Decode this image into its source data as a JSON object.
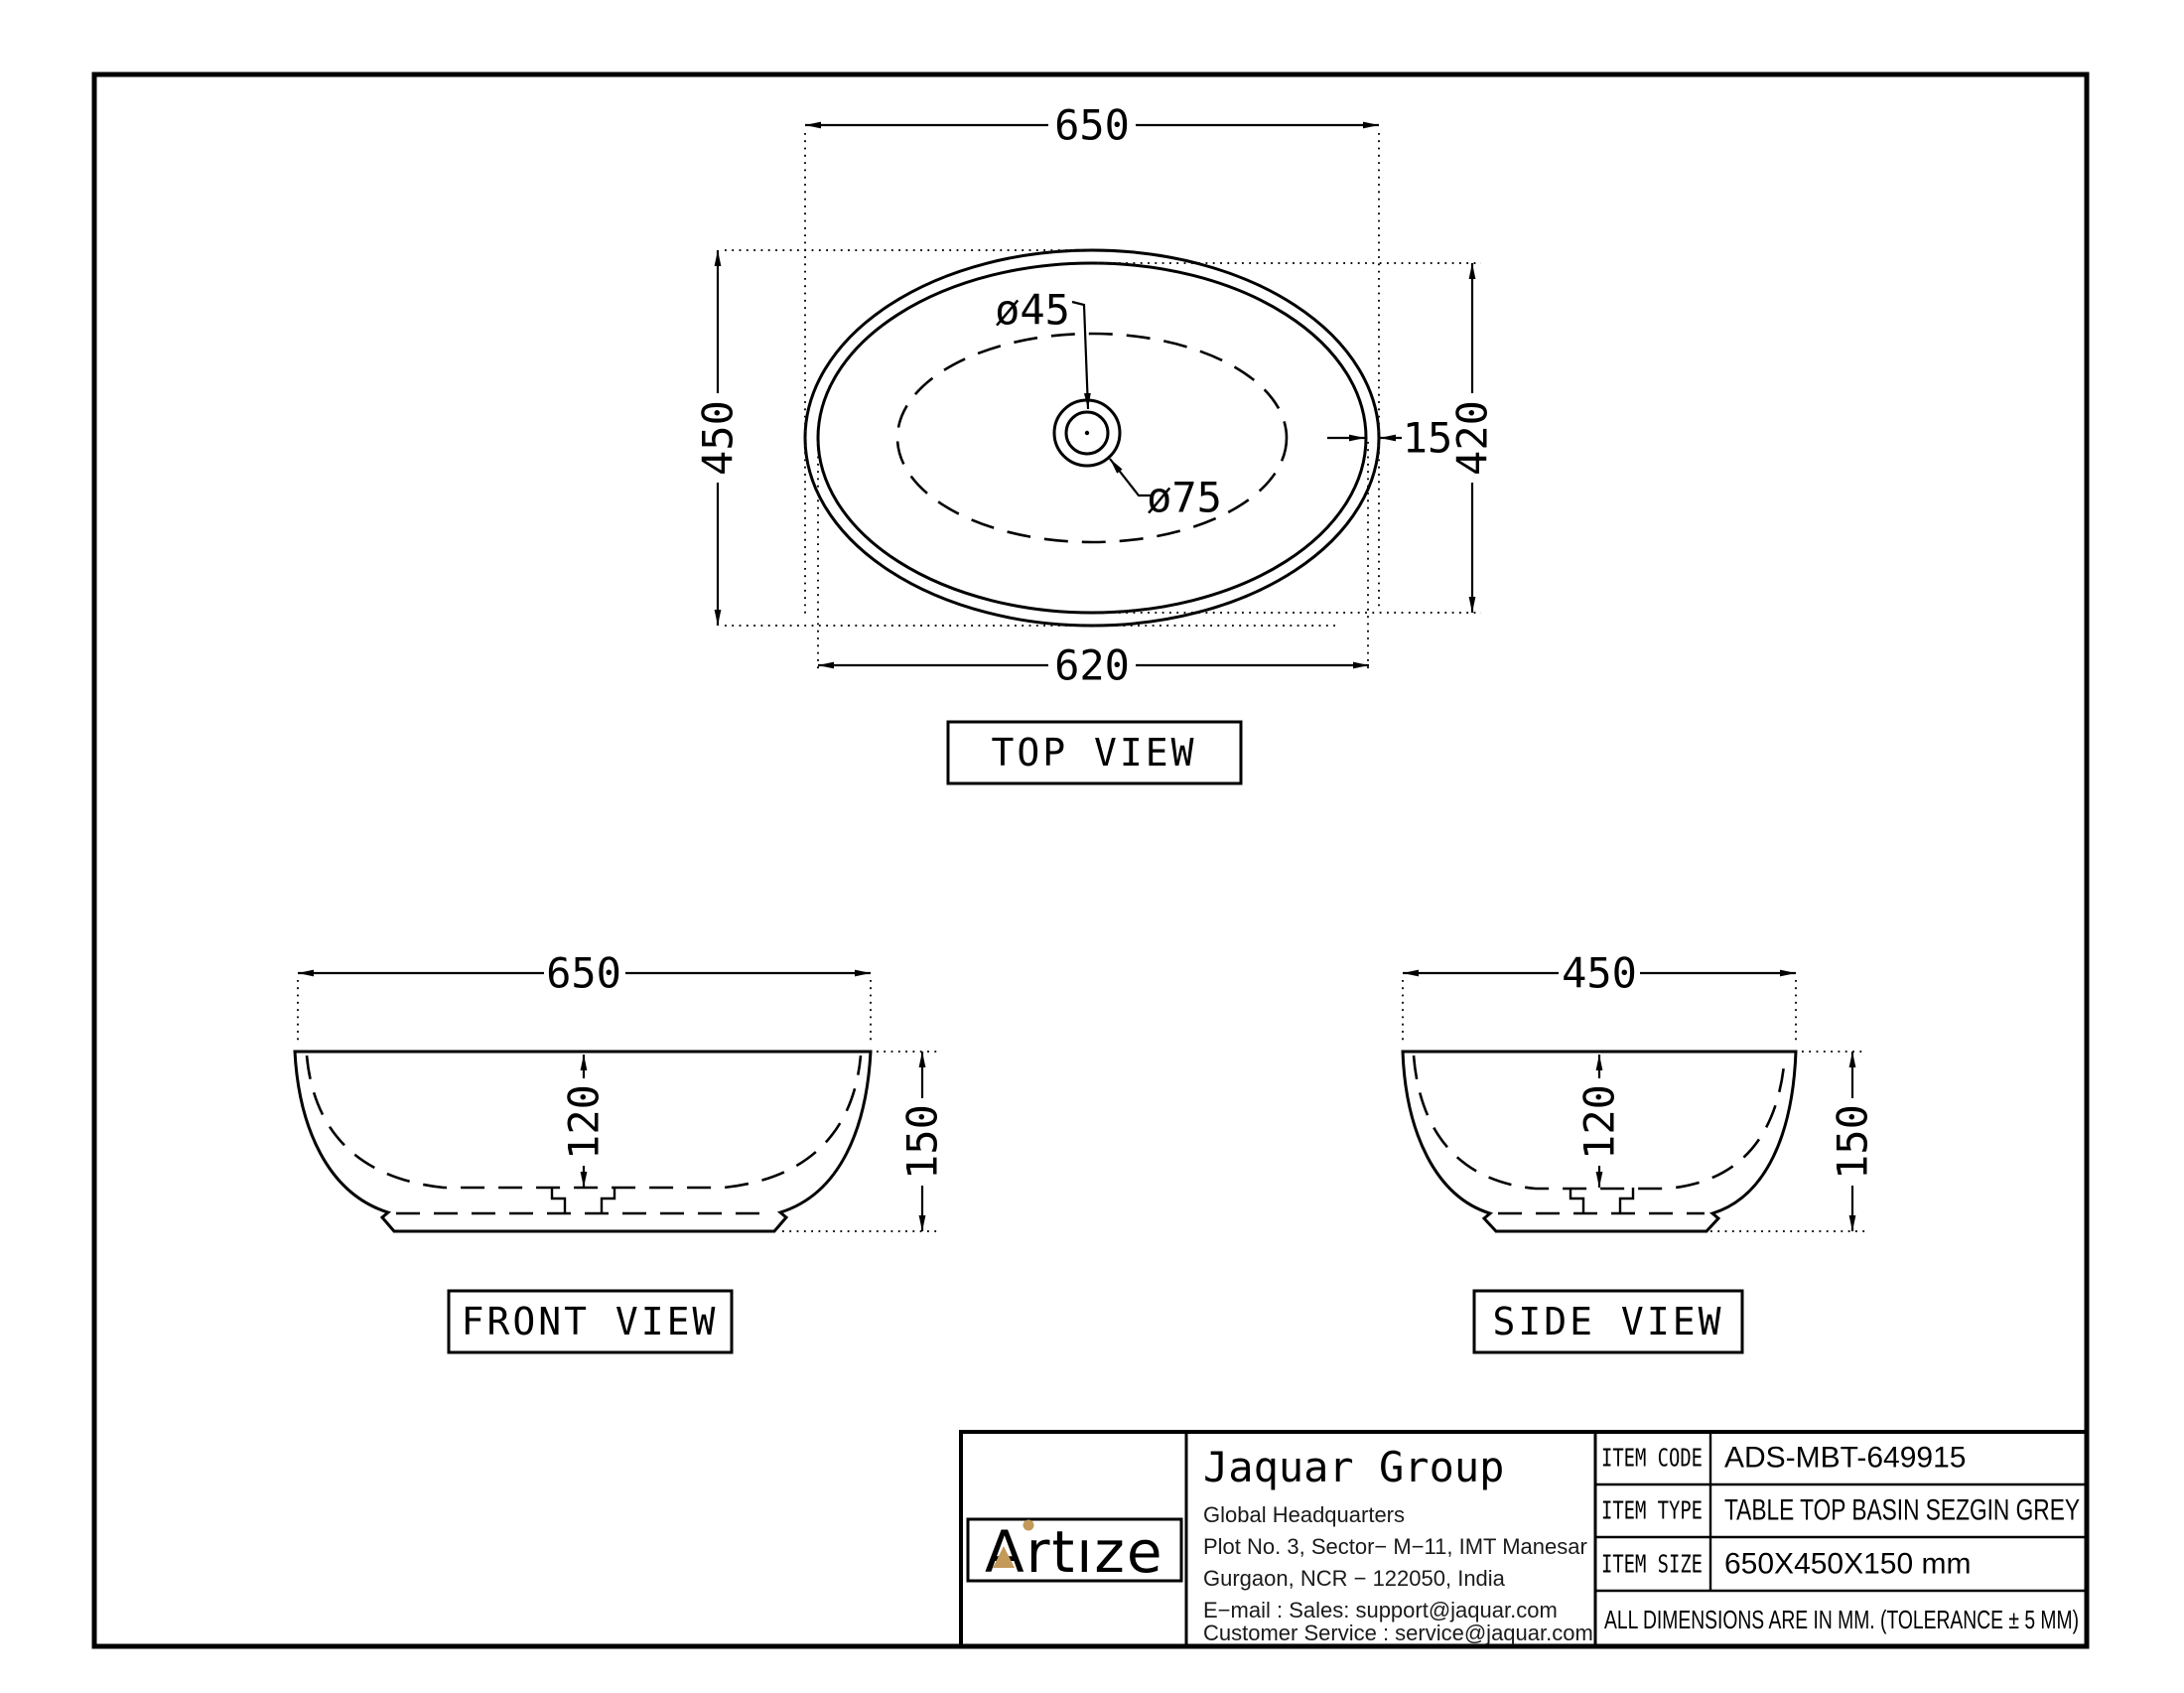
{
  "drawing": {
    "top_view": {
      "label": "TOP VIEW",
      "dim_width": "650",
      "dim_height": "450",
      "dim_inner_width": "620",
      "dim_inner_height": "420",
      "dim_rim_thickness": "15",
      "dim_drain_inner": "ø45",
      "dim_drain_outer": "ø75"
    },
    "front_view": {
      "label": "FRONT VIEW",
      "dim_width": "650",
      "dim_depth": "120",
      "dim_height": "150"
    },
    "side_view": {
      "label": "SIDE VIEW",
      "dim_width": "450",
      "dim_depth": "120",
      "dim_height": "150"
    }
  },
  "title_block": {
    "logo_text": "Artıze",
    "company_name": "Jaquar Group",
    "address": [
      "Global Headquarters",
      "Plot No. 3, Sector− M−11, IMT Manesar",
      "Gurgaon, NCR − 122050, India",
      "E−mail : Sales: support@jaquar.com",
      "Customer Service : service@jaquar.com"
    ],
    "item_code_label": "ITEM CODE",
    "item_code": "ADS-MBT-649915",
    "item_type_label": "ITEM TYPE",
    "item_type": "TABLE TOP BASIN SEZGIN GREY",
    "item_size_label": "ITEM SIZE",
    "item_size": "650X450X150 mm",
    "note": "ALL DIMENSIONS ARE IN MM. (TOLERANCE ± 5 MM)"
  },
  "colors": {
    "line": "#000000",
    "logo_gold": "#c39a59"
  }
}
